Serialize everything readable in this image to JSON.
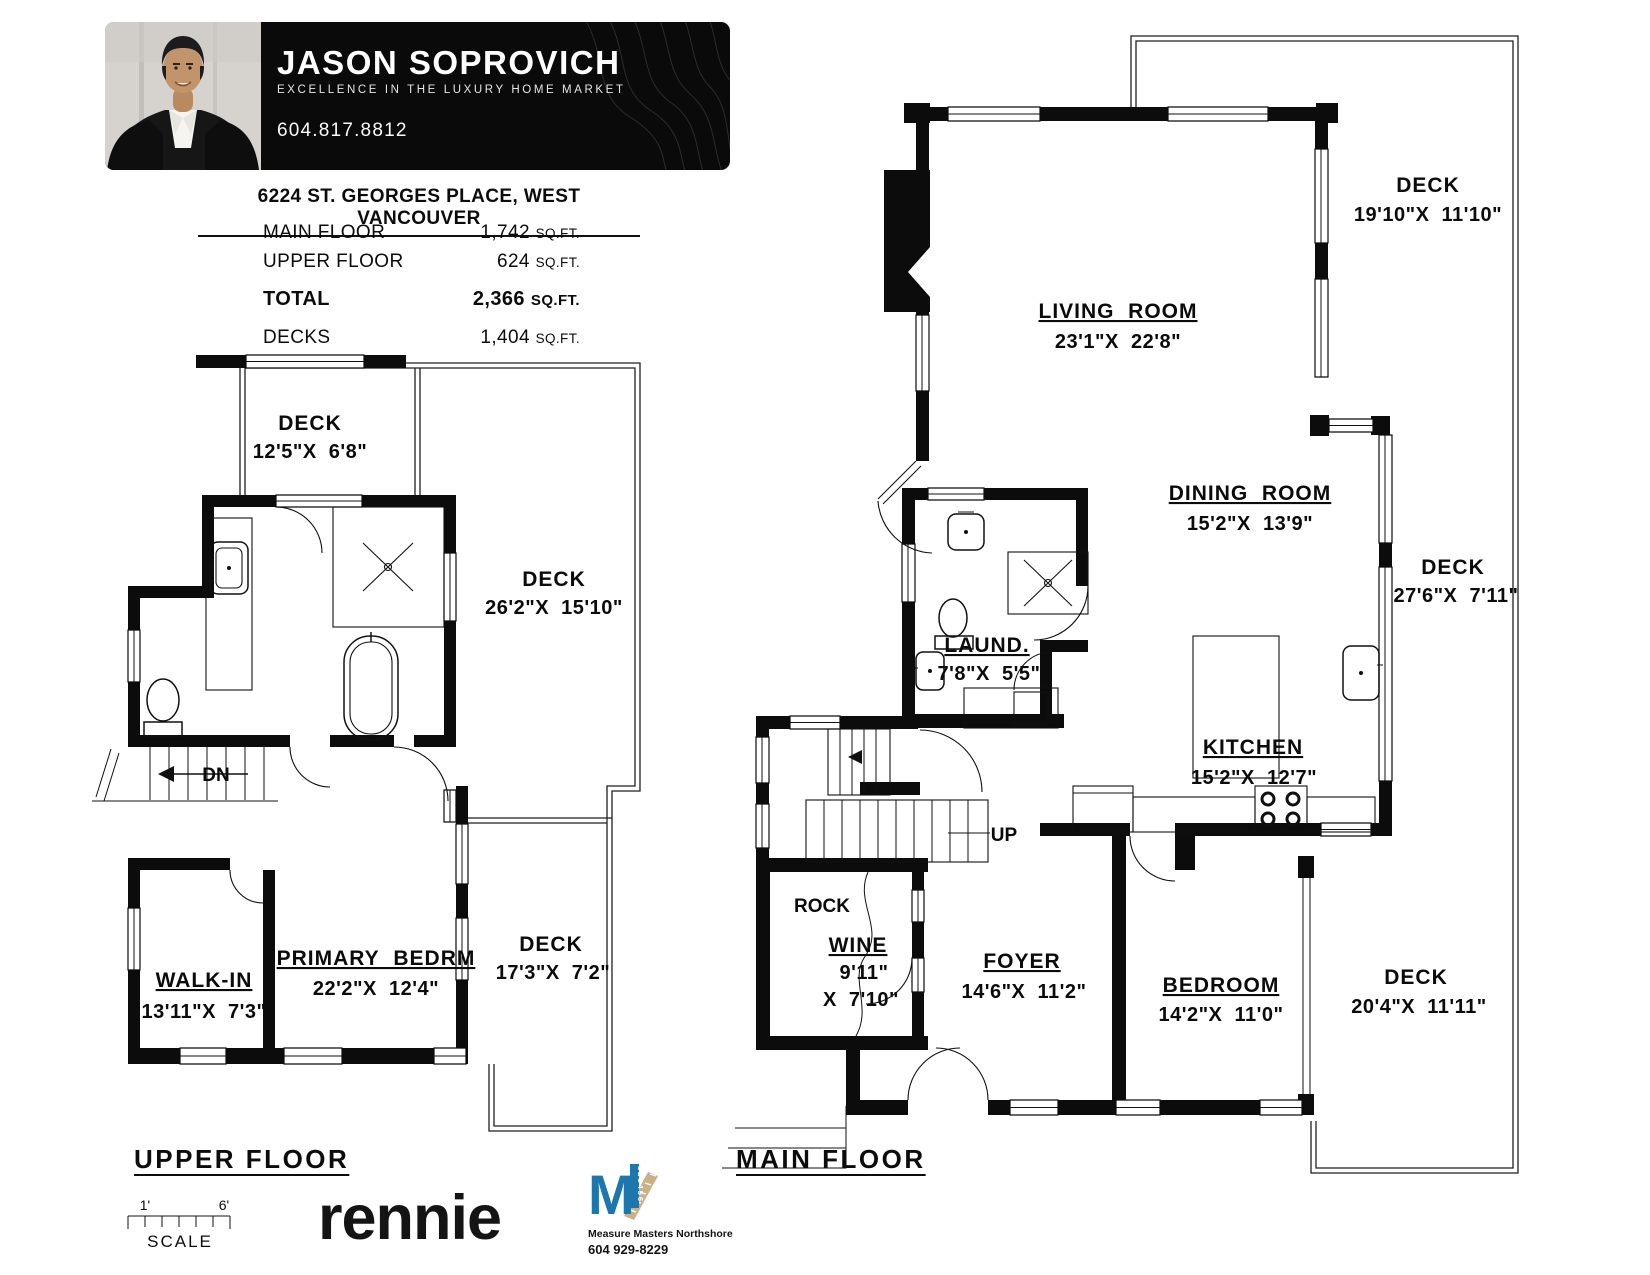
{
  "header": {
    "agent_name": "JASON SOPROVICH",
    "tagline": "EXCELLENCE IN THE LUXURY HOME MARKET",
    "phone": "604.817.8812"
  },
  "listing": {
    "address": "6224 ST. GEORGES PLACE, WEST VANCOUVER",
    "areas": [
      {
        "label": "MAIN FLOOR",
        "value": "1,742",
        "unit": "SQ.FT."
      },
      {
        "label": "UPPER FLOOR",
        "value": "624",
        "unit": "SQ.FT."
      },
      {
        "label": "TOTAL",
        "value": "2,366",
        "unit": "SQ.FT."
      },
      {
        "label": "DECKS",
        "value": "1,404",
        "unit": "SQ.FT."
      }
    ]
  },
  "upper_floor": {
    "title": "UPPER FLOOR",
    "stairs_label": "DN",
    "rooms": {
      "deck_top": {
        "name": "DECK",
        "dims": "12'5\"X  6'8\""
      },
      "deck_right": {
        "name": "DECK",
        "dims": "26'2\"X  15'10\""
      },
      "walk_in": {
        "name": "WALK-IN",
        "dims": "13'11\"X  7'3\""
      },
      "primary": {
        "name": "PRIMARY  BEDRM",
        "dims": "22'2\"X  12'4\""
      },
      "deck_bottom": {
        "name": "DECK",
        "dims": "17'3\"X  7'2\""
      }
    }
  },
  "main_floor": {
    "title": "MAIN FLOOR",
    "stairs_label": "UP",
    "rooms": {
      "living": {
        "name": "LIVING  ROOM",
        "dims": "23'1\"X  22'8\""
      },
      "deck_top": {
        "name": "DECK",
        "dims": "19'10\"X  11'10\""
      },
      "dining": {
        "name": "DINING  ROOM",
        "dims": "15'2\"X  13'9\""
      },
      "deck_right": {
        "name": "DECK",
        "dims": "27'6\"X  7'11\""
      },
      "laundry": {
        "name": "LAUND.",
        "dims": "7'8\"X  5'5\""
      },
      "kitchen": {
        "name": "KITCHEN",
        "dims": "15'2\"X  12'7\""
      },
      "rock": "ROCK",
      "wine": {
        "name": "WINE",
        "dims_line1": "9'11\"",
        "dims_line2": "X  7'10\""
      },
      "foyer": {
        "name": "FOYER",
        "dims": "14'6\"X  11'2\""
      },
      "bedroom": {
        "name": "BEDROOM",
        "dims": "14'2\"X  11'0\""
      },
      "deck_bottom": {
        "name": "DECK",
        "dims": "20'4\"X  11'11\""
      }
    }
  },
  "footer": {
    "scale_label": "SCALE",
    "scale_start": "1'",
    "scale_end": "6'",
    "rennie_logo": "rennie",
    "measure_masters": {
      "monogram": "M",
      "name": "Measure Masters Northshore",
      "phone": "604 929-8229"
    }
  },
  "colors": {
    "banner_bg": "#0a0a0a",
    "plan_line": "#0c0c0c",
    "mm_blue": "#1d76ac",
    "mm_tan": "#cbb088"
  }
}
